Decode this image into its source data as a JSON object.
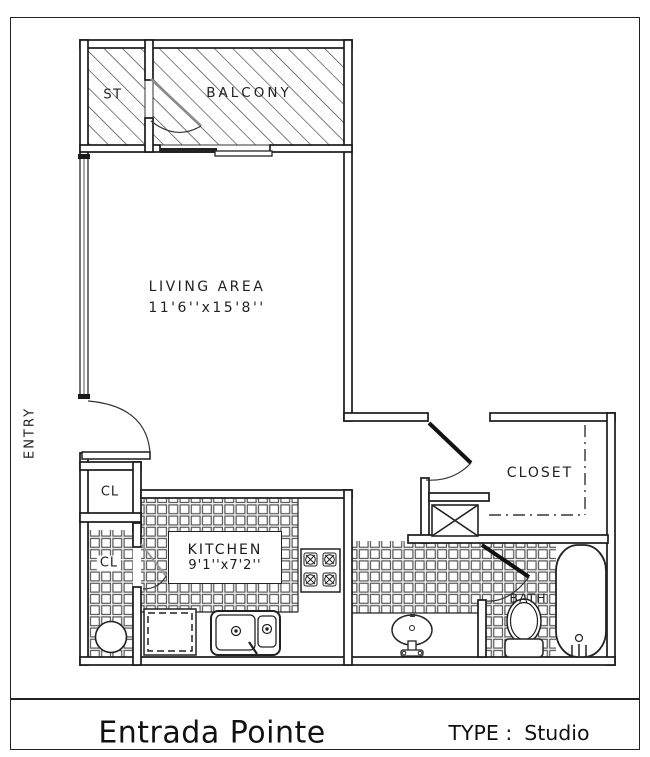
{
  "page": {
    "background": "#ffffff",
    "line_color": "#1a1a1a"
  },
  "plan": {
    "storage_label": "ST",
    "balcony_label": "BALCONY",
    "living_label": "LIVING AREA",
    "living_dims": "11'6''x15'8''",
    "entry_label": "ENTRY",
    "closet_upper_label": "CL",
    "closet_lower_label": "CL",
    "kitchen_label": "KITCHEN",
    "kitchen_dims": "9'1''x7'2''",
    "closet_label": "CLOSET",
    "bath_label": "BATH"
  },
  "footer": {
    "property_name": "Entrada Pointe",
    "type_label": "TYPE :",
    "type_value": "Studio"
  }
}
